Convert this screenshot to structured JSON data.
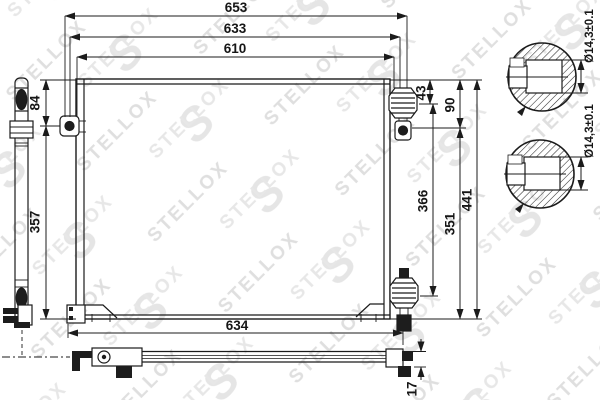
{
  "watermark": {
    "brand": "STELLOX",
    "monogram": "S"
  },
  "dims": {
    "top_overall": "653",
    "top_mid": "633",
    "top_inner": "610",
    "bottom_width": "634",
    "left_upper": "84",
    "left_lower": "357",
    "right_upper_small": "43",
    "right_upper": "90",
    "right_mid": "366",
    "right_lower": "351",
    "overall_height": "441",
    "profile_thickness": "17",
    "detail_top_diameter": "Ø14,3±0.1",
    "detail_bottom_diameter": "Ø14,3±0.1"
  }
}
